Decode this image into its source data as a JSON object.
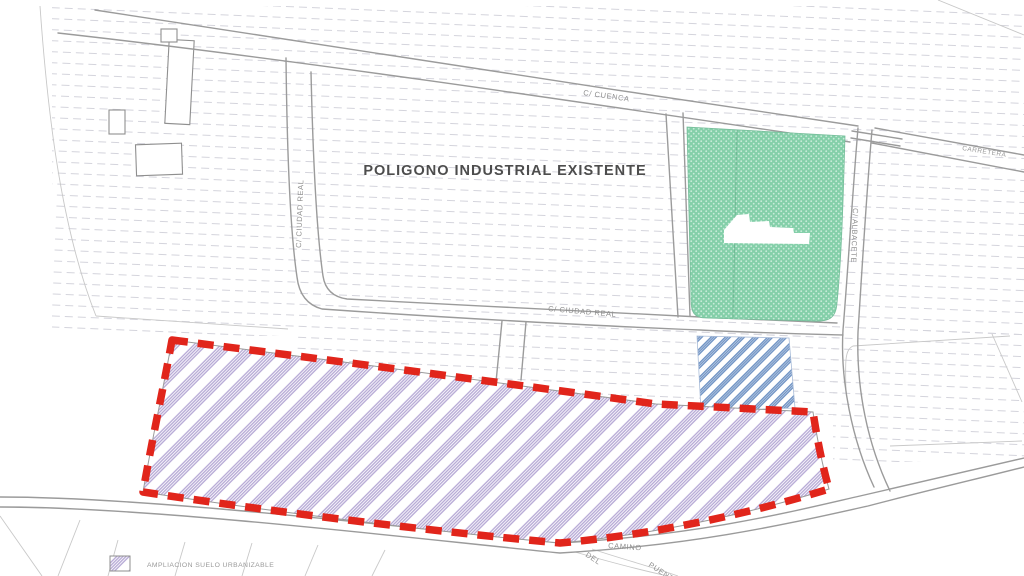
{
  "map": {
    "title": "POLIGONO INDUSTRIAL EXISTENTE",
    "road_labels": {
      "cuenca": "C/ CUENCA",
      "ciudad_real_left": "C/ CIUDAD REAL",
      "ciudad_real_mid": "C/ CIUDAD REAL",
      "albacete": "C/ ALBACETE",
      "carretera": "CARRETERA",
      "camino": "CAMINO",
      "del": "DEL",
      "puente": "PUENTE"
    },
    "legend": {
      "items": [
        {
          "swatch": "purple-diagonal-hatch",
          "label": "AMPLIACION SUELO URBANIZABLE"
        }
      ]
    },
    "zones": [
      {
        "name": "existing-industrial-estate",
        "style": "white-with-dashed-furrow-texture"
      },
      {
        "name": "green-stippled-parcel",
        "style": "green-stipple",
        "color": "#84cfa9"
      },
      {
        "name": "blue-hatched-parcel",
        "style": "blue-diagonal-hatch",
        "color": "#6e92c4"
      },
      {
        "name": "expansion-area",
        "style": "purple-diagonal-hatch",
        "hatch_color": "#b4a6d4",
        "outline_color": "#e1251b",
        "outline_style": "thick-red-dashed"
      }
    ],
    "colors": {
      "red_boundary": "#e1251b",
      "purple_hatch": "#b4a6d4",
      "blue_hatch": "#6e92c4",
      "green_fill": "#84cfa9",
      "road_line": "#9b9b9b",
      "texture_line": "#d4d4dc"
    }
  }
}
